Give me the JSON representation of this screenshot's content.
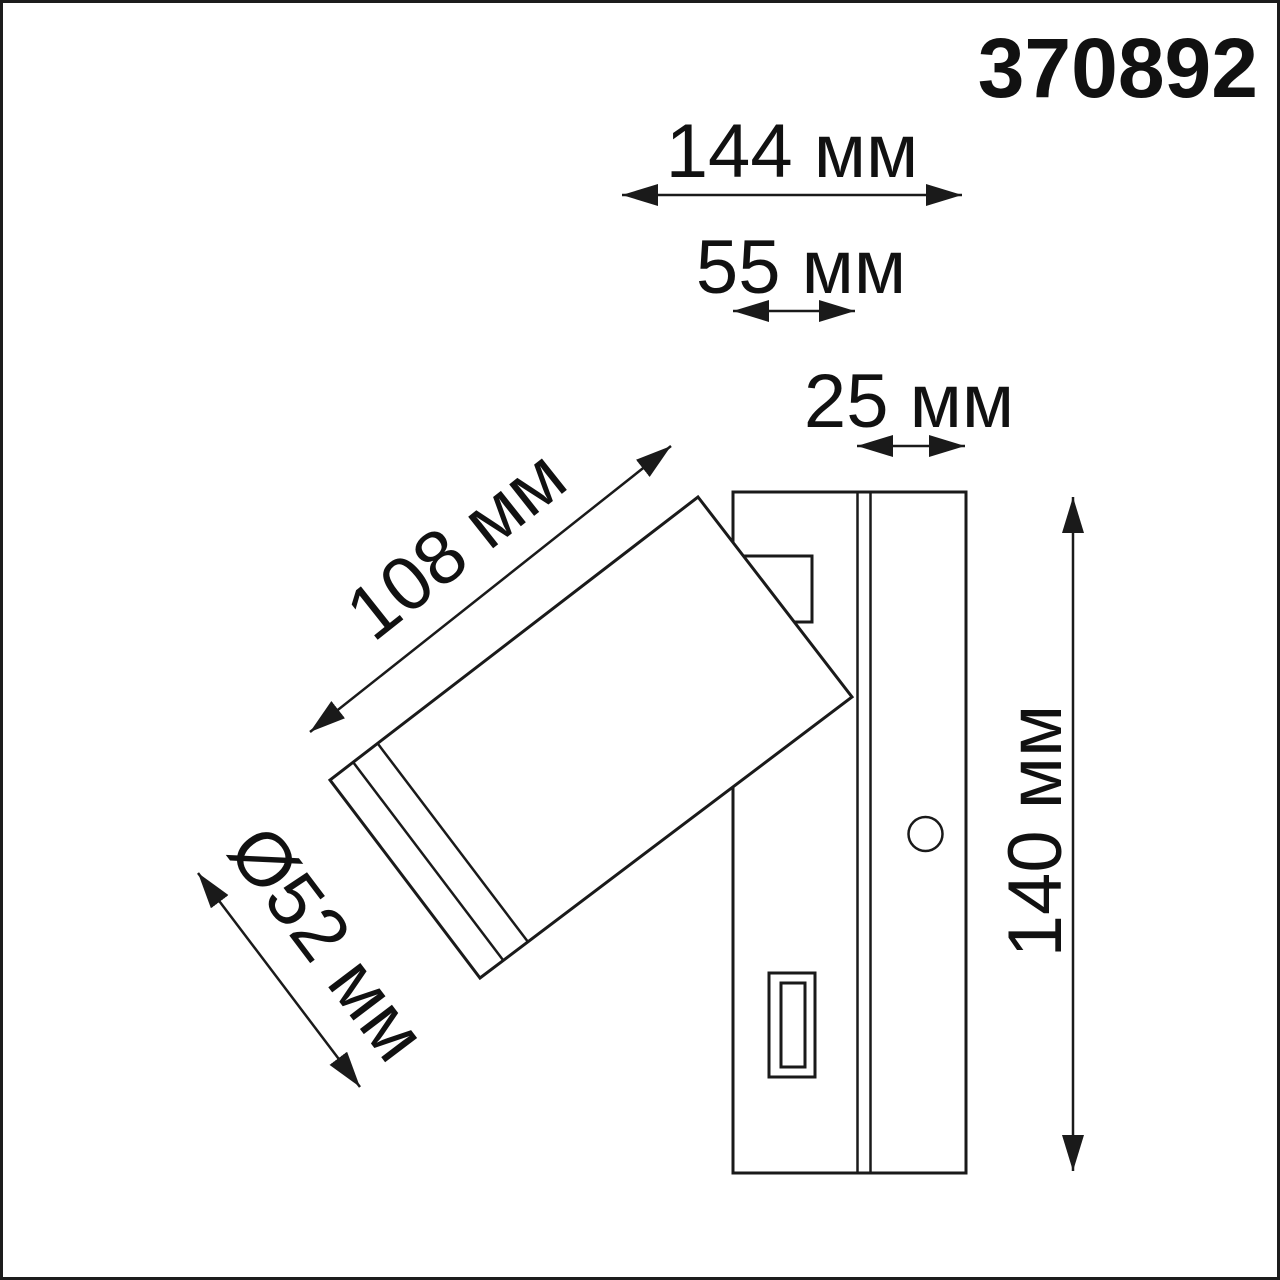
{
  "page": {
    "background_color": "#ffffff",
    "frame_color": "#1c1c1c"
  },
  "article": {
    "number": "370892"
  },
  "drawing": {
    "description": "Side-view dimension drawing of an adjustable wall spot luminaire with mounting plate, toggle switch and cylindrical lamp head",
    "line_color": "#1a1a1a",
    "dimensions": {
      "overall_width": {
        "label": "144 мм",
        "value": 144,
        "unit": "мм"
      },
      "plate_section_depth": {
        "label": "55 мм",
        "value": 55,
        "unit": "мм"
      },
      "base_depth": {
        "label": "25 мм",
        "value": 25,
        "unit": "мм"
      },
      "head_length": {
        "label": "108 мм",
        "value": 108,
        "unit": "мм"
      },
      "head_diameter": {
        "label": "Ø52 мм",
        "value": 52,
        "unit": "мм"
      },
      "overall_height": {
        "label": "140 мм",
        "value": 140,
        "unit": "мм"
      }
    }
  }
}
